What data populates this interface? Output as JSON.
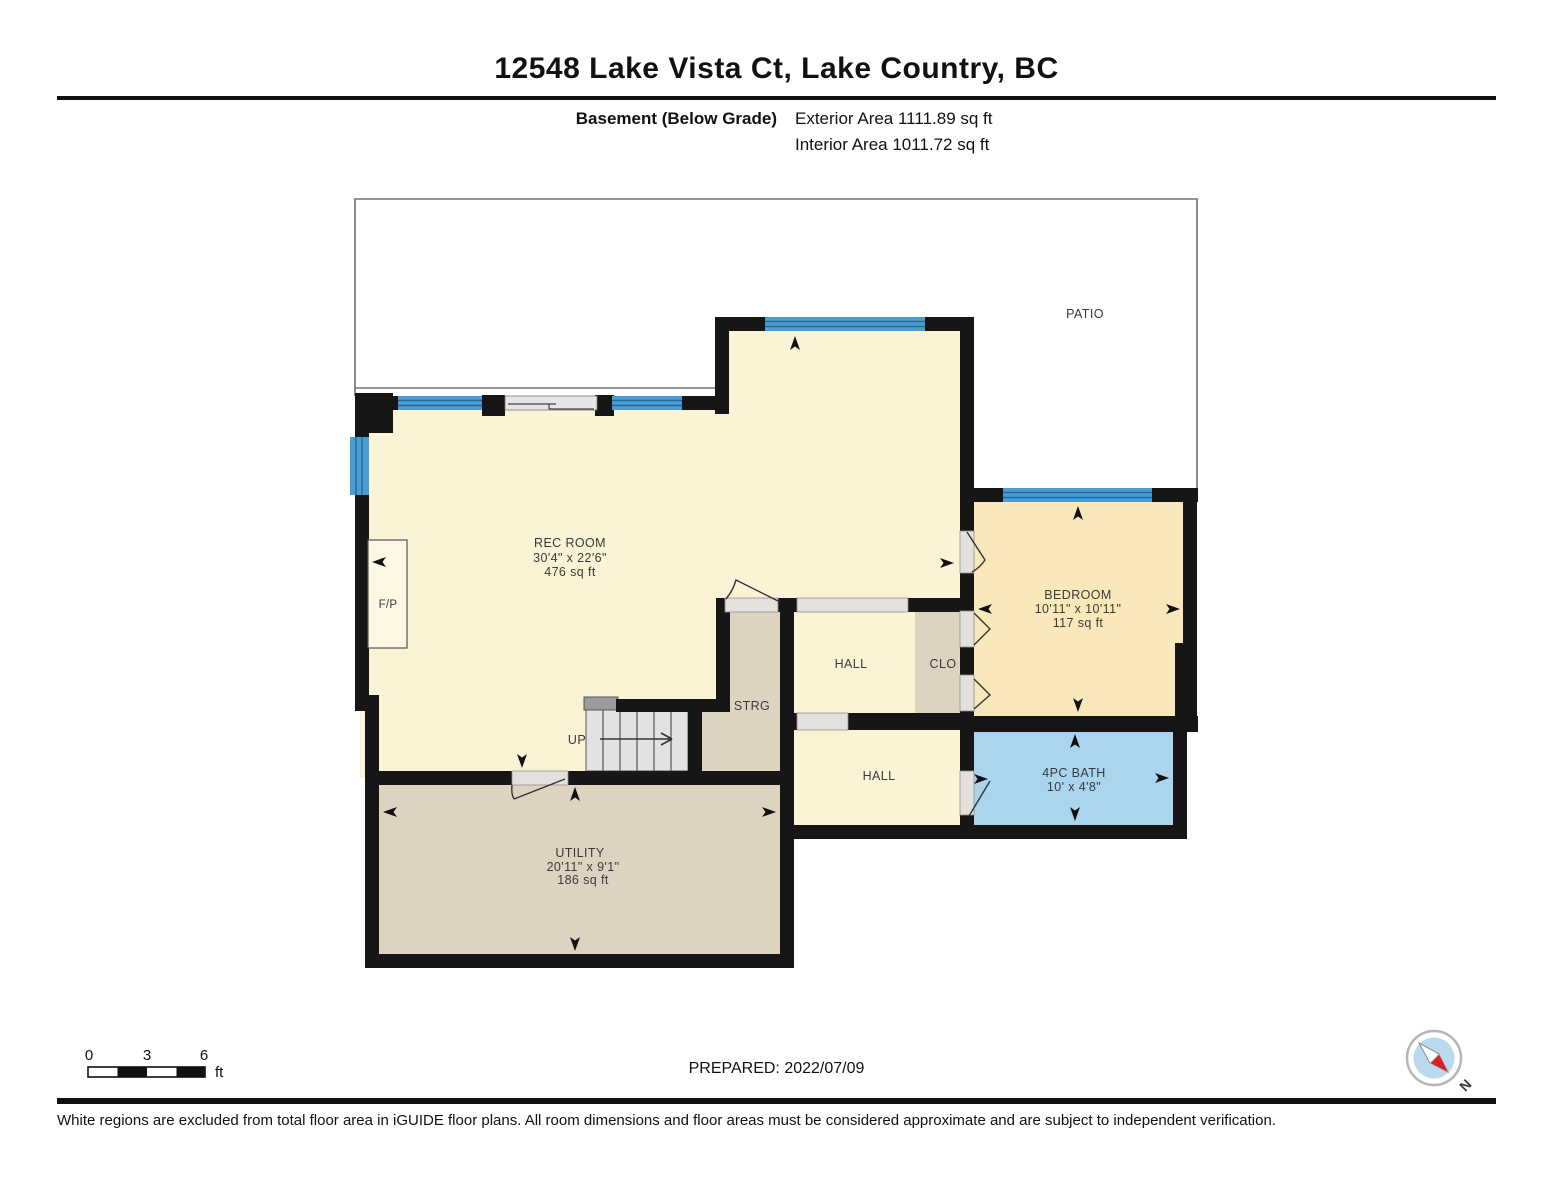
{
  "header": {
    "title": "12548 Lake Vista Ct, Lake Country, BC",
    "floor_label": "Basement (Below Grade)",
    "exterior_area": "Exterior Area 1111.89 sq ft",
    "interior_area": "Interior Area 1011.72 sq ft"
  },
  "plan": {
    "patio_label": "PATIO",
    "rec_room": {
      "name": "REC ROOM",
      "dims": "30'4\" x 22'6\"",
      "area": "476 sq ft"
    },
    "bedroom": {
      "name": "BEDROOM",
      "dims": "10'11\" x 10'11\"",
      "area": "117 sq ft"
    },
    "bath": {
      "name": "4PC BATH",
      "dims": "10' x 4'8\""
    },
    "utility": {
      "name": "UTILITY",
      "dims": "20'11\" x 9'1\"",
      "area": "186 sq ft"
    },
    "hall_upper": "HALL",
    "hall_lower": "HALL",
    "closet": "CLO",
    "storage": "STRG",
    "fireplace": "F/P",
    "stairs_up": "UP"
  },
  "scale_bar": {
    "tick0": "0",
    "tick1": "3",
    "tick2": "6",
    "unit": "ft"
  },
  "compass": {
    "north_label": "N"
  },
  "footer": {
    "prepared": "PREPARED: 2022/07/09",
    "disclaimer": "White regions are excluded from total floor area in iGUIDE floor plans. All room dimensions and floor areas must be considered approximate and are subject to independent verification."
  },
  "colors": {
    "wall": "#161616",
    "room_cream": "#fbf3d6",
    "bedroom_cream": "#f8e8ba",
    "tan": "#ded3c1",
    "bath_blue": "#abd4ee",
    "window_blue": "#4a9cd4",
    "window_line": "#26688f",
    "threshold_gray": "#e4e1dc",
    "stairs_gray": "#e2e2e2",
    "patio_outline": "#707070",
    "compass_red": "#d61f26",
    "compass_blue": "#b9d9ef"
  }
}
